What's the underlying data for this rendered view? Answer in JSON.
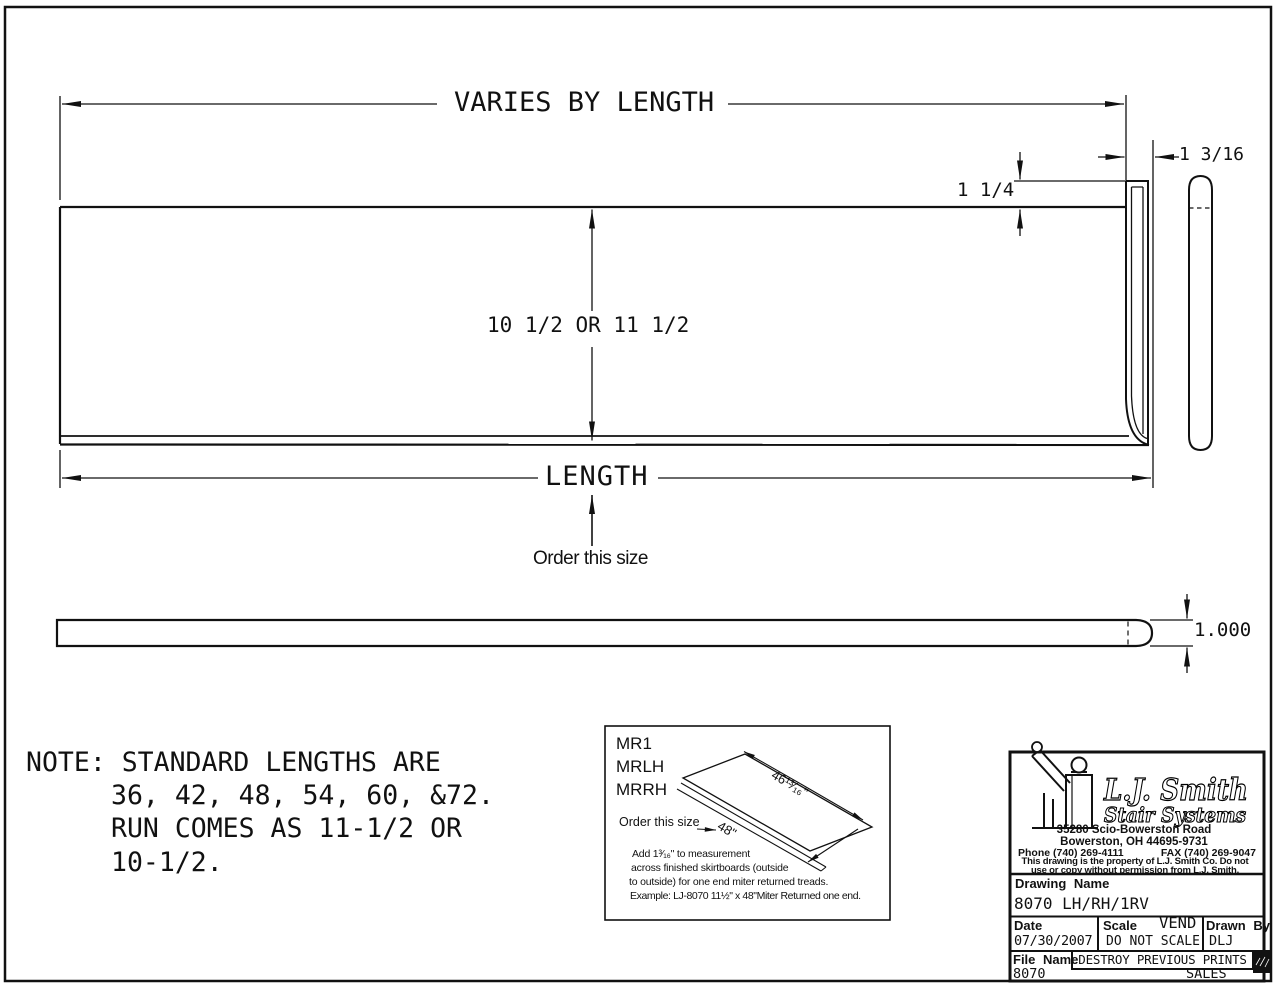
{
  "drawing": {
    "top_view": {
      "dim_varies": "VARIES BY LENGTH",
      "dim_return_width": "1 3/16",
      "dim_nosing": "1 1/4",
      "dim_depth": "10 1/2 OR 11 1/2",
      "dim_length": "LENGTH",
      "order_hint": "Order this size"
    },
    "profile_view": {
      "dim_thickness": "1.000"
    },
    "note": {
      "line1": "NOTE: STANDARD LENGTHS ARE",
      "line2": "36, 42, 48, 54, 60, &72.",
      "line3": "RUN COMES AS 11-1/2 OR",
      "line4": "10-1/2."
    },
    "inset": {
      "models": [
        "MR1",
        "MRLH",
        "MRRH"
      ],
      "dim_outside": "46¹³⁄₁₆\"",
      "dim_order": "48\"",
      "order_hint": "Order this size",
      "note1": "Add 1³⁄₁₆\" to measurement",
      "note2": "across finished skirtboards (outside",
      "note3": "to outside) for one end miter returned treads.",
      "note4": "Example: LJ-8070 11½\" x 48\"Miter Returned one end."
    }
  },
  "title_block": {
    "company": "L.J. Smith",
    "division": "Stair Systems",
    "address1": "35280 Scio-Bowerston Road",
    "address2": "Bowerston, OH 44695-9731",
    "phone": "Phone (740) 269-4111",
    "fax": "FAX (740) 269-9047",
    "legal1": "This drawing is the property of L.J. Smith Co. Do not",
    "legal2": "use or copy without permission from L.J. Smith.",
    "drawing_name_label": "Drawing Name",
    "drawing_name": "8070 LH/RH/1RV",
    "date_label": "Date",
    "date": "07/30/2007",
    "scale_label": "Scale",
    "vend": "VEND",
    "scale": "DO NOT SCALE",
    "drawn_by_label": "Drawn By",
    "drawn_by": "DLJ",
    "file_name_label": "File Name",
    "file_name": "8070",
    "destroy_note": "DESTROY PREVIOUS PRINTS",
    "department": "SALES"
  }
}
